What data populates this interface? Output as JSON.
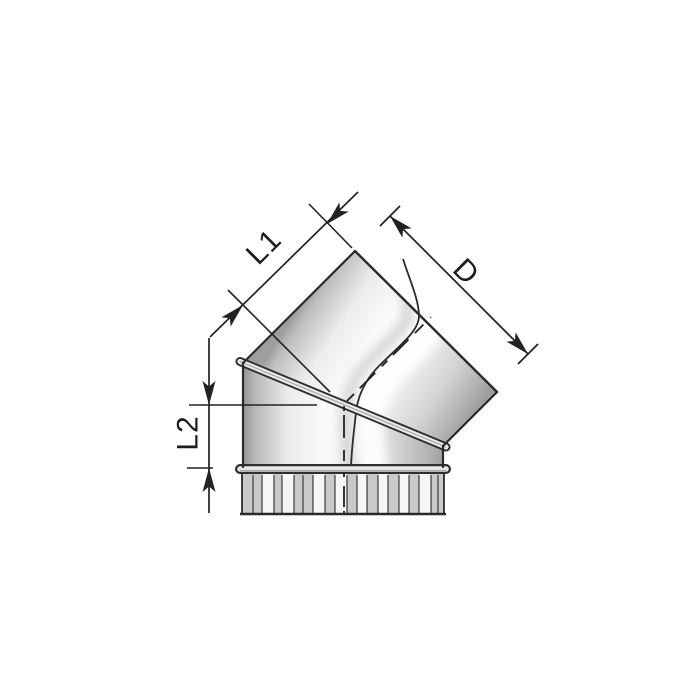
{
  "figure": {
    "labels": {
      "l1": "L1",
      "l2": "L2",
      "d": "D"
    },
    "colors": {
      "line": "#2a2a2a",
      "dimension_line": "#222222",
      "background": "#ffffff",
      "metal_dark": "#9e9e9e",
      "metal_light": "#fbfbfb",
      "crimp_gray": "#c9c9c9",
      "crimp_white": "#f6f6f6"
    }
  }
}
